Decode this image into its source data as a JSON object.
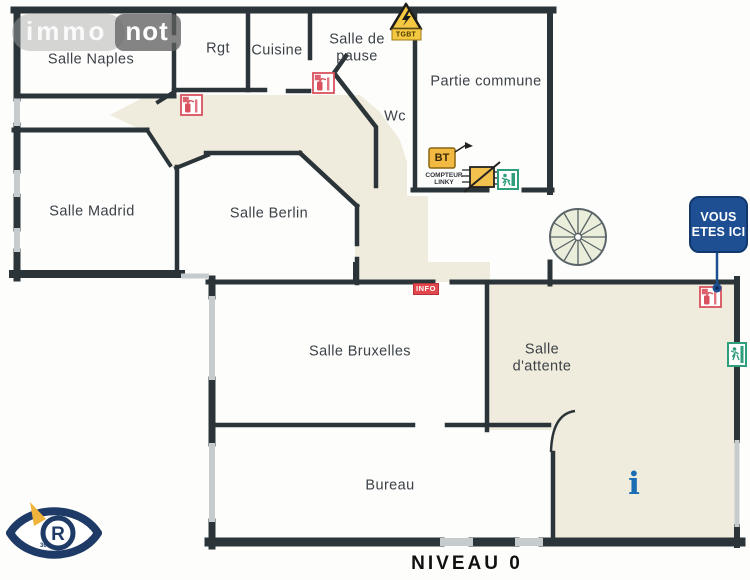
{
  "page": {
    "level_label": "NIVEAU 0"
  },
  "rooms": {
    "naples": {
      "label": "Salle Naples"
    },
    "rgt": {
      "label": "Rgt"
    },
    "cuisine": {
      "label": "Cuisine"
    },
    "pause": {
      "line1": "Salle de",
      "line2": "pause"
    },
    "partie_commune": {
      "label": "Partie commune"
    },
    "wc": {
      "label": "Wc"
    },
    "madrid": {
      "label": "Salle Madrid"
    },
    "berlin": {
      "label": "Salle Berlin"
    },
    "bruxelles": {
      "label": "Salle Bruxelles"
    },
    "attente": {
      "line1": "Salle",
      "line2": "d'attente"
    },
    "bureau": {
      "label": "Bureau"
    }
  },
  "markers": {
    "tgbt_label": "TGBT",
    "bt_label": "BT",
    "compteur_line1": "COMPTEUR",
    "compteur_line2": "LINKY",
    "info_tag": "INFO",
    "you_are_here": {
      "line1": "VOUS",
      "line2": "ETES ICI"
    },
    "info_point": "i"
  },
  "logos": {
    "immonot": {
      "part1": "immo",
      "part2": "not"
    },
    "eye": {
      "letter": "R",
      "small_text": "360"
    }
  },
  "icons": {
    "fire_extinguisher": "red extinguisher pictogram in white box",
    "emergency_exit": "green running-man exit pictogram",
    "electrical_hazard": "yellow triangle with lightning bolt",
    "electric_meter": "yellow slashed meter box",
    "spiral_staircase": "circular stair with radial treads",
    "info_point": "blue serif letter i",
    "you_are_here": "blue rounded sign with pointer"
  },
  "colors": {
    "wall": "#2b3539",
    "corridor_floor": "#f0ecdd",
    "marker_red": "#d9515e",
    "info_tag_red": "#e2474e",
    "safety_yellow": "#f2b943",
    "exit_green": "#2f9e7d",
    "you_are_here_blue": "#1d4f92",
    "info_point_blue": "#1a6db3",
    "logo_navy": "#1e3a66"
  }
}
